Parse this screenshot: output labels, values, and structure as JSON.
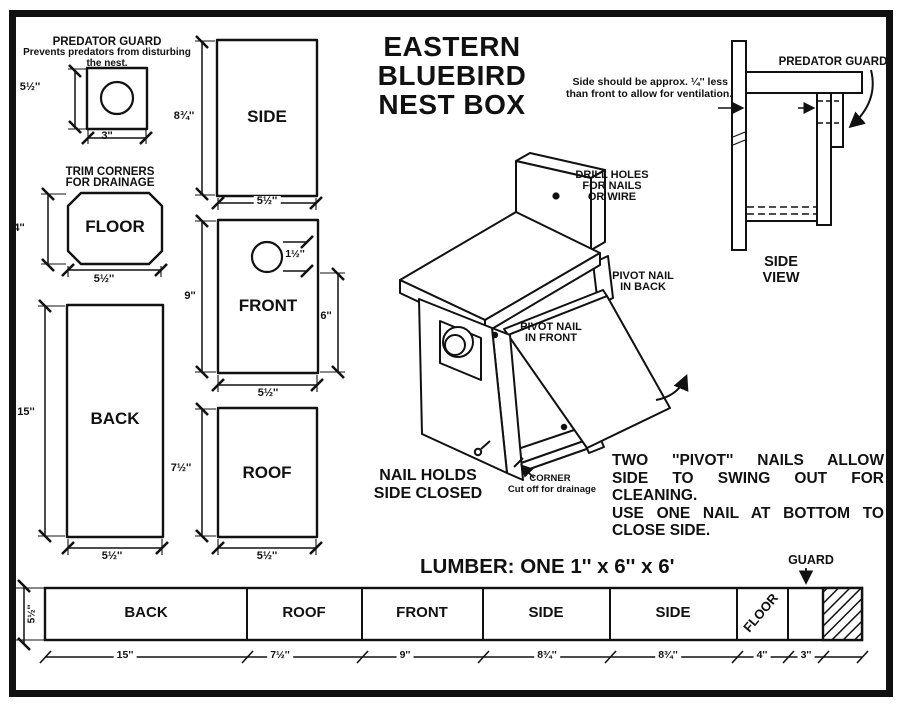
{
  "diagram_title": {
    "lines": [
      "EASTERN",
      "BLUEBIRD",
      "NEST BOX"
    ]
  },
  "predator_guard": {
    "heading": "PREDATOR GUARD",
    "description": [
      "Prevents predators from disturbing",
      "the nest."
    ],
    "height": "5½''",
    "width": "3''"
  },
  "floor": {
    "heading": [
      "TRIM CORNERS",
      "FOR DRAINAGE"
    ],
    "label": "FLOOR",
    "height": "4''",
    "width": "5½''"
  },
  "back": {
    "label": "BACK",
    "height": "15''",
    "width": "5½''"
  },
  "side": {
    "label": "SIDE",
    "height": "8¾''",
    "width": "5½''"
  },
  "front": {
    "label": "FRONT",
    "height": "9''",
    "width": "5½''",
    "hole_diameter": "1½''",
    "hole_height": "6''"
  },
  "roof": {
    "label": "ROOF",
    "height": "7½''",
    "width": "5½''"
  },
  "ventilation_note": [
    "Side should be approx. ¼'' less",
    "than front to allow for ventilation."
  ],
  "side_view": {
    "predator_guard_label": "PREDATOR GUARD",
    "caption": [
      "SIDE",
      "VIEW"
    ]
  },
  "assembly_view": {
    "drill_holes": [
      "DRILL HOLES",
      "FOR NAILS",
      "OR WIRE"
    ],
    "pivot_nail_back": [
      "PIVOT NAIL",
      "IN BACK"
    ],
    "pivot_nail_front": [
      "PIVOT NAIL",
      "IN FRONT"
    ],
    "nail_holds": [
      "NAIL HOLDS",
      "SIDE CLOSED"
    ],
    "corner_label": "CORNER",
    "corner_note": "Cut off for drainage"
  },
  "instructions": {
    "lines": [
      "TWO ''PIVOT'' NAILS ALLOW",
      "SIDE TO SWING OUT FOR",
      "CLEANING.",
      "USE ONE NAIL AT BOTTOM TO",
      "CLOSE SIDE."
    ]
  },
  "lumber": {
    "title": "LUMBER: ONE 1'' x 6'' x 6'",
    "guard_label": "GUARD",
    "board_height": "5½''",
    "sections": [
      {
        "label": "BACK",
        "length": "15''"
      },
      {
        "label": "ROOF",
        "length": "7½''"
      },
      {
        "label": "FRONT",
        "length": "9''"
      },
      {
        "label": "SIDE",
        "length": "8¾''"
      },
      {
        "label": "SIDE",
        "length": "8¾''"
      },
      {
        "label": "FLOOR",
        "length": "4''"
      },
      {
        "label": "",
        "length": "3''"
      }
    ]
  },
  "colors": {
    "ink": "#111111",
    "paper": "#ffffff"
  }
}
